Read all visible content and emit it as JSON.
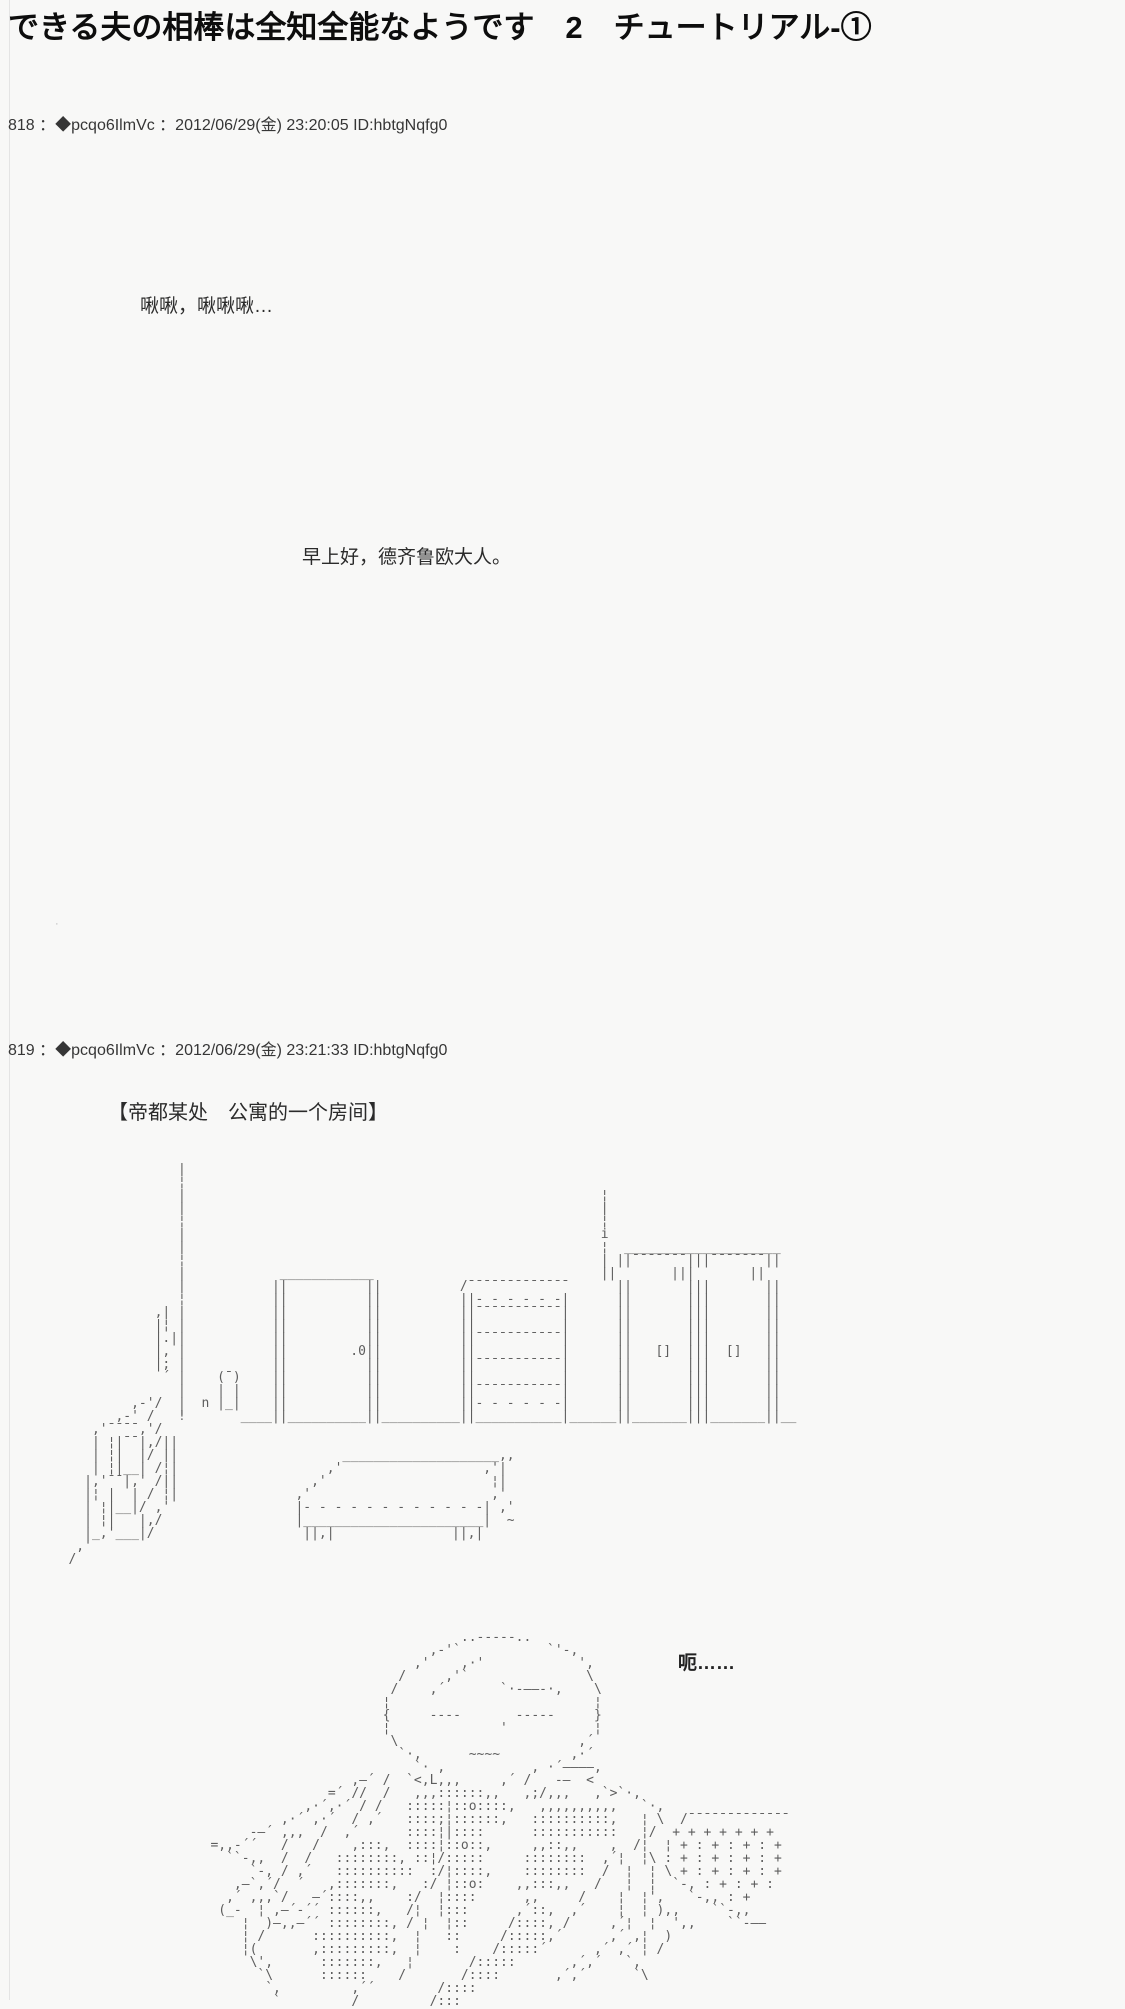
{
  "page": {
    "background": "#f8f8f7",
    "edge_line_color": "#e4e4e4",
    "aa_color": "#5d5d5d"
  },
  "thread": {
    "title": "できる夫の相棒は全知全能なようです　2　チュートリアル-①"
  },
  "posts": [
    {
      "header": "818 ：◆pcqo6IlmVc ：2012/06/29(金) 23:20:05 ID:hbtgNqfg0",
      "lines": [
        "啾啾，啾啾啾…",
        "早上好，德齐鲁欧大人。"
      ],
      "stray_mark": "·"
    },
    {
      "header": "819 ：◆pcqo6IlmVc ：2012/06/29(金) 23:21:33 ID:hbtgNqfg0",
      "scene": "【帝都某处　公寓的一个房间】",
      "speech": "呃……",
      "room_aa": [
        "",
        "                 |",
        "                 ¦",
        "                 |                                                     ¦",
        "                 |                                                     |",
        "                 ¦                                                     ¦",
        "                 |                                                     i",
        "                 |                                                     ¦  ____________________",
        "                 ¦                                                     | ||¯¯¯¯¯¯¯|||¯¯¯¯¯¯¯||",
        "                 |            ____________                             ||       |||       ||",
        "                 |           ||          ||          /¯¯¯¯¯¯¯¯¯¯¯¯¯      ||       |||       ||",
        "                 ¦           ||          ||          ||- - - - - -|      ||       |||       ||",
        "              ,| |           ||          ||          ||¯¯¯¯¯¯¯¯¯¯¯|      ||       |||       ||",
        "              |¦ |           ||          ||          ||           |      ||       |||       ||",
        "              |.||           ||          ||          ||¯¯¯¯¯¯¯¯¯¯¯|      ||       |||       ||",
        "              |, |           ||        .0||          ||           |      ||   []  |||  []   ||",
        "              |; |           ||          ||          ||¯¯¯¯¯¯¯¯¯¯¯|      ||       |||       ||",
        "               ´ |    (¯)    ||          ||          ||           |      ||       |||       ||",
        "                 |    | |    ||          ||          ||¯¯¯¯¯¯¯¯¯¯¯|      ||       |||       ||",
        "           ,-'/  |  n |_|    ||          ||          ||- - - - - -|      ||       |||       ||",
        "         ,-' /   !       ____||__________||__________||___________|______||_______|||_______||__",
        "      ,'¯¯¯¯,'/",
        "      | ¦|¯¯|,/||",
        "      | ¦|  |/ ||                     ____________________,,",
        "      | ¦|__| /¦|                   ,'                  ,'|",
        "     |,'¯¯|,' /||                 ,'                     ¦|",
        "     |¦ |  | / ¦|               ,'                       ,'",
        "     | ¦|__|/ ,'                |- - - - - - - - - - - -| ,'",
        "     | ¦|   |,/                 |_______________________|  ~",
        "     |_,'___|/                   ||,|               ||,|",
        "    ,'",
        "   /"
      ],
      "character_aa": [
        "",
        "",
        "",
        "                                         ..-----..",
        "                                     ,-'`           `'-,",
        "                                   ,'    ,·'            ',",
        "                                 /     ,'`               \\",
        "                                /    ,´       `·-——-·,    \\",
        "                               ¦                          ¦",
        "                               {     ----       -----     }",
        "                               ¦              '           ¦",
        "                                \\                       ,´",
        "                                 `·,      ~~~~         ,·´",
        "                                   `· ,           , ·´————,",
        "                           ,—´ /  `<,L,,,     ,´ /   -—  <",
        "                        =´ //  /   ,,,::::::,,   ,;/,,,   ,`>`·,",
        "                     ,·´,·´ / /   :::::¦::o::::,   ,,,,,,,,,,   `·,",
        "                  ,·´ ,·´  / ,´   ::::;¦::::::,   ::::::::::,   ¦ \\  /¯¯¯¯¯¯¯¯¯¯¯¯¯",
        "              -—´ ,,,  /  ,´      ::::¦|::::      :::::::::::   ¦/  + + + + + + +",
        "         =,,-´´   /   /    ,:::,  ::::¦::o::,     ,,::,,    ,  /¦  ¦ + : + : + : +",
        "           ``-,,  /  /   ::::::::, ::¦/:::::     ::::::::  ,´¦  ¦\\ : + : + : + : +",
        "              `-, / ,´   ::::::::::  :/¦::::,    ::::::::  /  ¦  ¦ \\ + : + : + : +",
        "            ,—`,´/  ´   ,:::::::,   :/ ¦::o:    ,,:::,,   /   ¦  ¦  `-, : + : + :",
        "           ,´ ,,,`/   —´::::,,    :/  ¦::::      ,,     /    ¦  ¦',   `-,, : +",
        "          (_-  ¦ ,—´-´´ ::::::,   /¦  ¦:::      ,´::,  ,´    ¦  ¦ ),,    ``-,,",
        "             ¦  )—,,—´´ ::::::::, / ¦  ¦::     /::::, /     ,´¦  ¦  ',,    ``-——",
        "             ¦ /      ::::::::::,  ¦   ::     /:::::,´      ,´ ,¦  )",
        "             ¦(       ,:::::::::,  ¦    :    /:::::´      ,´ ,´ ¦ /",
        "              \\',      :::::::,   ¦       /:::::       ,´,´   `,",
        "               `\\      ::::::    /       /::::       ,´,´      `\\",
        "                `,         ,´´        /::::",
        "                 `         /         /:::"
      ]
    }
  ]
}
